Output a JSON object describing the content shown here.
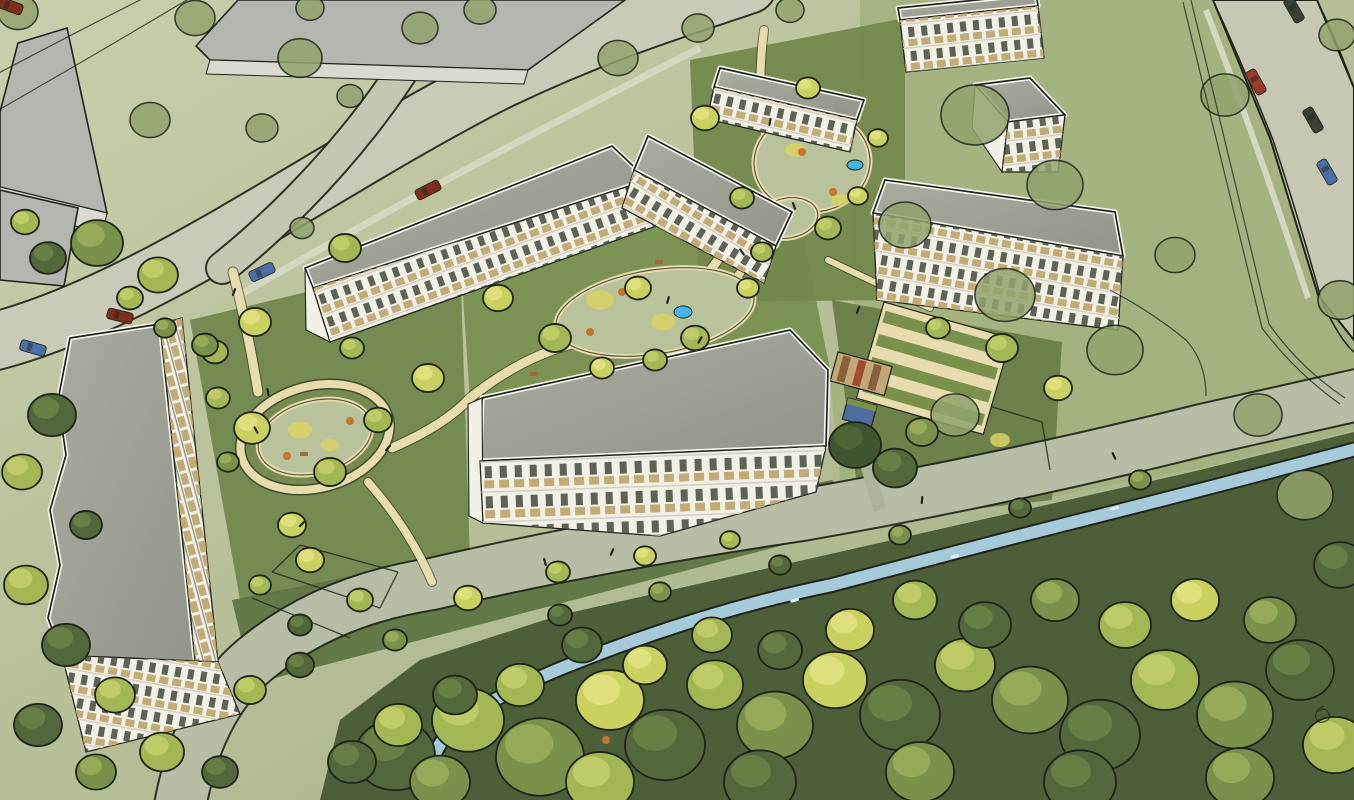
{
  "meta": {
    "kind": "architectural-aerial-watercolor-illustration",
    "subject": "bird's-eye sketch of a residential development: white apartment slabs with gray roofs and tan balconies around green courtyards with play areas and ponds; context buildings top-left, roads with cars, meadow right, stream and dense tree canopy along the bottom",
    "visible_text": ""
  },
  "palette": {
    "groundLight": "#c9cfac",
    "groundMid": "#b4bd95",
    "groundDeep": "#9fae80",
    "meadow": "#a3b17e",
    "forestBase": "#4c5f38",
    "road": "#c9cbb8",
    "roadSide": "#c4c7b2",
    "roadSouth": "#b8bda6",
    "roadRight": "#c6c8b4",
    "sidewalk": "#d6d7c0",
    "grayPath": "#aeb49c",
    "pathCream": "#e6dcad",
    "sage": "#b8c29b",
    "stream": "#a7cadb",
    "pond": "#45b5e8",
    "roofA": "#aaac9f",
    "roofB": "#92958a",
    "parapet": "#f7f6ef",
    "facade": "#f2f1e8",
    "windowDark": "#434a3b",
    "balconyTan": "#c2ab76",
    "floorLine": "#d5d1c0",
    "contextGray": "#b5b6b0",
    "contextWall": "#dadad2",
    "lawnWest": "#72884e",
    "lawnCentral": "#78904f",
    "lawnNorth": "#74894d",
    "lawnSouth": "#5f7543",
    "lawnEast": "#697f47",
    "ink": "#20241a",
    "carRed": "#9c3a2a",
    "carBlue": "#4a6ea6",
    "carDark": "#3a4034",
    "carDarkRed": "#7c2e1f",
    "treeBright": "#c9d160",
    "treeYellow": "#d8d263",
    "treeMid": "#a3b755",
    "treeGreen": "#79914a",
    "treeDark": "#52683a",
    "treeDarkest": "#3f5530",
    "treeOlive": "#93a36e",
    "orange": "#c4742f",
    "brown": "#9c6b40",
    "shedTan": "#c2a878",
    "shedBrown": "#8a5f3c",
    "shedRed": "#a34a2a",
    "shedBlue": "#4f6c9c"
  },
  "forest_underlay": "320,800 340,720 420,660 560,615 760,570 980,520 1200,470 1354,432 1354,800",
  "meadow_right": "860,0 1213,0 1270,140 1320,300 1354,340 1354,430 1200,468 1050,497 900,520 845,530 830,380 855,330 850,160 860,60",
  "lawns": [
    {
      "name": "lawn-west",
      "pts": "190,320 460,255 470,560 240,600",
      "fill": "lawnWest"
    },
    {
      "name": "lawn-central",
      "pts": "460,250 790,168 832,380 472,432",
      "fill": "lawnCentral"
    },
    {
      "name": "lawn-north",
      "pts": "690,60 905,18 905,300 700,302",
      "fill": "lawnNorth"
    },
    {
      "name": "lawn-south",
      "pts": "232,600 832,480 872,522 252,684",
      "fill": "lawnSouth"
    },
    {
      "name": "lawn-east",
      "pts": "832,300 1062,342 1052,500 862,522",
      "fill": "lawnEast"
    }
  ],
  "roads": [
    {
      "name": "main-road",
      "d": "M-8,342 C 150,302 330,165 500,80 C 600,32 680,8 748,-15",
      "width": 56,
      "fill": "road"
    },
    {
      "name": "side-street",
      "d": "M441,-6 C 420,62 330,182 222,268",
      "width": 30,
      "fill": "roadSide"
    },
    {
      "name": "south-road",
      "d": "M180,806 Q200,700 262,654 Q330,600 432,584 Q600,545 802,515 Q1002,480 1202,430 Q1300,408 1362,394",
      "width": 50,
      "fill": "roadSouth"
    }
  ],
  "road_right": {
    "name": "right-road",
    "pts": "1213,0 1317,0 1354,88 1354,340 1318,295 1270,138",
    "fill": "roadRight",
    "edges": [
      "M1213,0 Q1245,70 1273,140 Q1300,222 1322,302 Q1340,340 1354,352",
      "M1317,0 Q1338,44 1354,88"
    ]
  },
  "sidewalks": [
    {
      "d": "M238,296 Q420,190 700,48",
      "width": 7
    },
    {
      "d": "M1206,10 Q1256,140 1308,298",
      "width": 6
    }
  ],
  "stream": {
    "d": "M432,812 Q420,760 452,730 Q484,700 562,668 Q700,612 832,585 Q982,545 1082,520 Q1202,490 1360,448",
    "width": 12
  },
  "gray_path": {
    "d": "M880,510 L856,428",
    "width": 13
  },
  "paths": [
    {
      "d": "M233,272 Q248,330 258,392",
      "width": 9
    },
    {
      "d": "M368,482 Q410,530 432,582",
      "width": 8
    },
    {
      "d": "M392,448 Q445,425 470,398 Q520,358 572,344 Q650,322 700,282 Q728,252 744,212",
      "width": 9
    },
    {
      "d": "M764,30 Q756,90 766,140 Q776,190 760,235 Q748,268 724,292",
      "width": 8
    },
    {
      "d": "M766,150 Q820,158 862,176",
      "width": 6
    },
    {
      "d": "M828,260 Q880,285 930,308",
      "width": 6
    }
  ],
  "play_ring": {
    "cx": 315,
    "cy": 437,
    "rx": 76,
    "ry": 51,
    "rot": -15
  },
  "sage_patches": [
    {
      "cx": 315,
      "cy": 437,
      "rx": 58,
      "ry": 36,
      "rot": -15
    },
    {
      "cx": 655,
      "cy": 312,
      "rx": 100,
      "ry": 42,
      "rot": -9
    },
    {
      "cx": 812,
      "cy": 162,
      "rx": 58,
      "ry": 50,
      "rot": -4
    },
    {
      "cx": 788,
      "cy": 218,
      "rx": 30,
      "ry": 20,
      "rot": -10
    }
  ],
  "yellow_patches": [
    [
      600,
      300,
      14
    ],
    [
      663,
      322,
      12
    ],
    [
      300,
      430,
      12
    ],
    [
      795,
      150,
      10
    ],
    [
      840,
      200,
      9
    ],
    [
      1000,
      440,
      10
    ],
    [
      330,
      445,
      9
    ]
  ],
  "orange_dots": [
    [
      622,
      292
    ],
    [
      700,
      332
    ],
    [
      590,
      332
    ],
    [
      802,
      152
    ],
    [
      833,
      192
    ],
    [
      762,
      212
    ],
    [
      287,
      456
    ],
    [
      350,
      421
    ],
    [
      1012,
      352
    ],
    [
      606,
      740
    ],
    [
      912,
      752
    ]
  ],
  "brown_dots": [
    [
      745,
      238
    ],
    [
      688,
      352
    ],
    [
      300,
      452
    ],
    [
      530,
      372
    ],
    [
      655,
      260
    ]
  ],
  "ponds": [
    [
      683,
      312,
      9,
      6
    ],
    [
      855,
      165,
      8,
      5
    ]
  ],
  "fences": [
    [
      300,
      545,
      398,
      572
    ],
    [
      272,
      572,
      380,
      608
    ],
    [
      252,
      598,
      350,
      638
    ],
    [
      398,
      572,
      380,
      608
    ],
    [
      300,
      545,
      272,
      572
    ],
    [
      930,
      388,
      1042,
      422
    ],
    [
      1042,
      422,
      1050,
      470
    ],
    [
      930,
      388,
      922,
      430
    ]
  ],
  "terraces": {
    "x": 884,
    "y": 302,
    "w": 132,
    "h": 100,
    "rot": 16,
    "rows": 4
  },
  "sheds": [
    {
      "x": 838,
      "y": 352,
      "w": 56,
      "h": 30,
      "rot": 15,
      "type": "striped"
    },
    {
      "x": 848,
      "y": 398,
      "w": 30,
      "h": 22,
      "rot": 15,
      "type": "blue"
    }
  ],
  "context_buildings": [
    {
      "name": "context-slab-nw",
      "roof": "18,43 67,28 107,213 0,187 0,112",
      "wall": "0,187 107,213 103,232 0,210"
    },
    {
      "name": "context-slab-top",
      "roof": "196,46 238,0 625,0 528,70 210,60",
      "wall": "210,60 528,70 524,84 206,74"
    },
    {
      "name": "context-wing-w",
      "roof": "0,190 78,208 64,286 0,280",
      "wall": ""
    }
  ],
  "buildings": [
    {
      "name": "left-slab",
      "roof": "70,338 160,324 196,668 62,655 48,618 60,565 50,510 66,455 58,400",
      "facades": [
        {
          "pts": "160,324 196,668 218,662 182,318",
          "rot": 75,
          "pat": "balc"
        },
        {
          "pts": "62,655 218,662 240,714 86,752",
          "rot": 10,
          "pat": "fac"
        }
      ]
    },
    {
      "name": "north-slab",
      "roof": "305,268 612,146 648,180 313,288",
      "facades": [
        {
          "pts": "313,288 648,180 662,224 330,342",
          "rot": -20,
          "pat": "fac"
        }
      ],
      "walls": [
        "305,268 313,288 330,342 306,330"
      ]
    },
    {
      "name": "north-slab-east",
      "roof": "648,136 792,212 776,246 634,170",
      "facades": [
        {
          "pts": "634,170 776,246 764,283 622,208",
          "rot": 31,
          "pat": "fac"
        }
      ]
    },
    {
      "name": "ne-slab",
      "roof": "720,68 864,100 857,120 714,87",
      "facades": [
        {
          "pts": "714,87 857,120 850,152 707,119",
          "rot": 13,
          "pat": "fac"
        }
      ]
    },
    {
      "name": "top-edge-slab",
      "roof": "898,8 1036,-6 1038,6 900,20",
      "facades": [
        {
          "pts": "900,20 1038,6 1044,58 906,72",
          "rot": -6,
          "pat": "fac"
        }
      ]
    },
    {
      "name": "small-block",
      "roof": "975,85 1030,78 1065,115 1008,122",
      "facades": [
        {
          "pts": "1008,122 1065,115 1058,172 1002,172",
          "rot": -7,
          "pat": "fac"
        }
      ],
      "walls": [
        "975,85 1008,122 1002,172 972,128"
      ]
    },
    {
      "name": "east-slab",
      "roof": "885,180 1115,212 1123,256 873,213",
      "facades": [
        {
          "pts": "873,213 1123,256 1118,330 877,300",
          "rot": 10,
          "pat": "fac"
        }
      ]
    },
    {
      "name": "central-slab",
      "roof": "482,398 790,330 828,370 826,446 480,461",
      "facades": [
        {
          "pts": "480,461 826,446 816,492 660,536 483,523",
          "rot": -2,
          "pat": "facC"
        }
      ],
      "walls": [
        "468,404 482,398 483,523 469,516"
      ]
    }
  ],
  "trees": [
    [
      395,
      755,
      40,
      "d"
    ],
    [
      468,
      720,
      36,
      "m"
    ],
    [
      540,
      757,
      44,
      "g"
    ],
    [
      610,
      700,
      34,
      "b"
    ],
    [
      665,
      745,
      40,
      "d"
    ],
    [
      715,
      685,
      28,
      "m"
    ],
    [
      775,
      725,
      38,
      "g"
    ],
    [
      835,
      680,
      32,
      "b"
    ],
    [
      900,
      715,
      40,
      "d"
    ],
    [
      965,
      665,
      30,
      "m"
    ],
    [
      1030,
      700,
      38,
      "g"
    ],
    [
      1100,
      735,
      40,
      "d"
    ],
    [
      1165,
      680,
      34,
      "m"
    ],
    [
      1235,
      715,
      38,
      "g"
    ],
    [
      1300,
      670,
      34,
      "d"
    ],
    [
      1335,
      745,
      32,
      "m"
    ],
    [
      1270,
      620,
      26,
      "g"
    ],
    [
      1195,
      600,
      24,
      "b"
    ],
    [
      1340,
      565,
      26,
      "d"
    ],
    [
      1125,
      625,
      26,
      "m"
    ],
    [
      1055,
      600,
      24,
      "g"
    ],
    [
      985,
      625,
      26,
      "d"
    ],
    [
      915,
      600,
      22,
      "m"
    ],
    [
      850,
      630,
      24,
      "b"
    ],
    [
      780,
      650,
      22,
      "d"
    ],
    [
      712,
      635,
      20,
      "m"
    ],
    [
      645,
      665,
      22,
      "b"
    ],
    [
      582,
      645,
      20,
      "d"
    ],
    [
      520,
      685,
      24,
      "m"
    ],
    [
      455,
      695,
      22,
      "d"
    ],
    [
      398,
      725,
      24,
      "m"
    ],
    [
      352,
      762,
      24,
      "d"
    ],
    [
      440,
      782,
      30,
      "g"
    ],
    [
      600,
      782,
      34,
      "m"
    ],
    [
      760,
      782,
      36,
      "d"
    ],
    [
      920,
      772,
      34,
      "g"
    ],
    [
      1080,
      782,
      36,
      "d"
    ],
    [
      1240,
      778,
      34,
      "g"
    ],
    [
      560,
      615,
      12,
      "d"
    ],
    [
      660,
      592,
      11,
      "g"
    ],
    [
      780,
      565,
      11,
      "d"
    ],
    [
      900,
      535,
      11,
      "g"
    ],
    [
      1020,
      508,
      11,
      "d"
    ],
    [
      1140,
      480,
      11,
      "g"
    ],
    [
      975,
      115,
      34,
      "o"
    ],
    [
      1055,
      185,
      28,
      "o"
    ],
    [
      905,
      225,
      26,
      "o"
    ],
    [
      1005,
      295,
      30,
      "o"
    ],
    [
      1115,
      350,
      28,
      "o"
    ],
    [
      955,
      415,
      24,
      "o"
    ],
    [
      1225,
      95,
      24,
      "o"
    ],
    [
      1175,
      255,
      20,
      "o"
    ],
    [
      1258,
      415,
      24,
      "o"
    ],
    [
      1305,
      495,
      28,
      "o"
    ],
    [
      1340,
      300,
      22,
      "o"
    ],
    [
      1337,
      35,
      18,
      "o"
    ],
    [
      97,
      243,
      26,
      "g"
    ],
    [
      158,
      275,
      20,
      "m"
    ],
    [
      48,
      258,
      18,
      "d"
    ],
    [
      25,
      222,
      14,
      "m"
    ],
    [
      300,
      58,
      22,
      "o"
    ],
    [
      195,
      18,
      20,
      "o"
    ],
    [
      420,
      28,
      18,
      "o"
    ],
    [
      262,
      128,
      16,
      "o"
    ],
    [
      350,
      96,
      13,
      "o"
    ],
    [
      480,
      10,
      16,
      "o"
    ],
    [
      150,
      120,
      20,
      "o"
    ],
    [
      18,
      12,
      20,
      "o"
    ],
    [
      310,
      8,
      14,
      "o"
    ],
    [
      618,
      58,
      20,
      "o"
    ],
    [
      698,
      28,
      16,
      "o"
    ],
    [
      790,
      10,
      14,
      "o"
    ],
    [
      52,
      415,
      24,
      "d"
    ],
    [
      22,
      472,
      20,
      "m"
    ],
    [
      86,
      525,
      16,
      "d"
    ],
    [
      26,
      585,
      22,
      "m"
    ],
    [
      66,
      645,
      24,
      "d"
    ],
    [
      115,
      695,
      20,
      "m"
    ],
    [
      38,
      725,
      24,
      "d"
    ],
    [
      162,
      752,
      22,
      "m"
    ],
    [
      220,
      772,
      18,
      "d"
    ],
    [
      96,
      772,
      20,
      "g"
    ],
    [
      345,
      248,
      16,
      "m"
    ],
    [
      302,
      228,
      12,
      "o"
    ],
    [
      255,
      322,
      16,
      "b"
    ],
    [
      215,
      352,
      13,
      "m"
    ],
    [
      130,
      298,
      13,
      "m"
    ],
    [
      165,
      328,
      11,
      "g"
    ],
    [
      252,
      428,
      18,
      "b"
    ],
    [
      330,
      472,
      16,
      "m"
    ],
    [
      292,
      525,
      14,
      "b"
    ],
    [
      378,
      420,
      14,
      "m"
    ],
    [
      428,
      378,
      16,
      "b"
    ],
    [
      352,
      348,
      12,
      "m"
    ],
    [
      228,
      462,
      11,
      "g"
    ],
    [
      205,
      345,
      13,
      "g"
    ],
    [
      218,
      398,
      12,
      "m"
    ],
    [
      310,
      560,
      14,
      "b"
    ],
    [
      360,
      600,
      13,
      "m"
    ],
    [
      300,
      625,
      12,
      "d"
    ],
    [
      395,
      640,
      12,
      "g"
    ],
    [
      260,
      585,
      11,
      "m"
    ],
    [
      250,
      690,
      16,
      "m"
    ],
    [
      300,
      665,
      14,
      "d"
    ],
    [
      498,
      298,
      15,
      "b"
    ],
    [
      555,
      338,
      16,
      "m"
    ],
    [
      638,
      288,
      13,
      "b"
    ],
    [
      695,
      338,
      14,
      "m"
    ],
    [
      748,
      288,
      11,
      "b"
    ],
    [
      602,
      368,
      12,
      "b"
    ],
    [
      655,
      360,
      12,
      "m"
    ],
    [
      705,
      118,
      14,
      "b"
    ],
    [
      742,
      198,
      12,
      "m"
    ],
    [
      808,
      88,
      12,
      "b"
    ],
    [
      828,
      228,
      13,
      "m"
    ],
    [
      878,
      138,
      10,
      "b"
    ],
    [
      762,
      252,
      11,
      "m"
    ],
    [
      858,
      196,
      10,
      "b"
    ],
    [
      1002,
      348,
      16,
      "m"
    ],
    [
      1058,
      388,
      14,
      "b"
    ],
    [
      938,
      328,
      12,
      "m"
    ],
    [
      855,
      445,
      26,
      "k"
    ],
    [
      895,
      468,
      22,
      "d"
    ],
    [
      922,
      432,
      16,
      "g"
    ],
    [
      468,
      598,
      14,
      "b"
    ],
    [
      558,
      572,
      12,
      "m"
    ],
    [
      645,
      556,
      11,
      "b"
    ],
    [
      730,
      540,
      10,
      "m"
    ]
  ],
  "cars": [
    [
      262,
      272,
      -25,
      "carBlue"
    ],
    [
      428,
      190,
      -27,
      "carDarkRed"
    ],
    [
      120,
      316,
      14,
      "carDarkRed"
    ],
    [
      33,
      348,
      16,
      "carBlue"
    ],
    [
      10,
      6,
      20,
      "carDarkRed"
    ],
    [
      1256,
      82,
      60,
      "carRed"
    ],
    [
      1313,
      120,
      60,
      "carDark"
    ],
    [
      1327,
      172,
      60,
      "carBlue"
    ],
    [
      1294,
      10,
      60,
      "carDark"
    ]
  ],
  "people": [
    [
      234,
      292,
      20
    ],
    [
      256,
      430,
      -30
    ],
    [
      302,
      524,
      45
    ],
    [
      770,
      122,
      10
    ],
    [
      794,
      206,
      -20
    ],
    [
      700,
      340,
      30
    ],
    [
      545,
      562,
      -15
    ],
    [
      612,
      552,
      25
    ],
    [
      922,
      500,
      5
    ],
    [
      1114,
      456,
      -25
    ],
    [
      388,
      448,
      40
    ],
    [
      268,
      392,
      -10
    ],
    [
      668,
      300,
      15
    ],
    [
      742,
      252,
      -35
    ],
    [
      858,
      310,
      20
    ]
  ],
  "ink_lines": [
    "M-5,75 Q80,30 150,-5",
    "M-5,112 Q100,52 195,-5",
    "M1183,2 Q1222,165 1262,328 Q1295,372 1340,404",
    "M1191,0 Q1230,162 1269,324 Q1300,368 1345,398",
    "M1110,290 Q1152,312 1186,340 Q1206,362 1206,396",
    "M1318,712 q6,-6 10,0 q4,6 -2,9 q-8,4 -10,-3 q-2,-8 8,-12"
  ],
  "stream_glints": [
    [
      520,
      692
    ],
    [
      640,
      648
    ],
    [
      790,
      600
    ],
    [
      950,
      556
    ],
    [
      1110,
      508
    ]
  ]
}
